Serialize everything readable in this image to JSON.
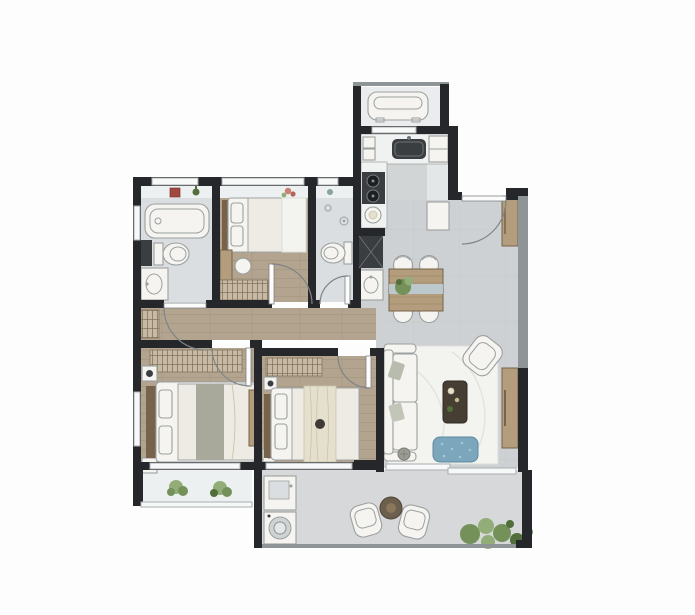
{
  "meta": {
    "type": "apartment-floor-plan",
    "description": "Top-down rendered floor plan of a 3-bedroom, 2-bath apartment with kitchen, equipment platform, dining/living area and long south balcony. No text labels are rendered in the plan."
  },
  "colors": {
    "wall": "#26272a",
    "wallSoft": "#8f9497",
    "windowFill": "#f7f8f8",
    "windowFrame": "#a9aeb1",
    "floorWood": "#b3a490",
    "floorWoodLine": "#9b8c76",
    "floorTile": "#cdd1d3",
    "tileLine": "#c3c7c9",
    "floorBath": "#dbdee0",
    "floorKitchen": "#e4e7e8",
    "counter": "#f0f1f1",
    "floorPlatform": "#ebeced",
    "floorBalcony": "#d6d8d9",
    "sill": "#edf0f1",
    "furnWhite": "#f5f4f0",
    "furnStroke": "#9ba09f",
    "furnWood": "#b49d7c",
    "furnWoodDark": "#77634b",
    "tableDark": "#473e33",
    "linen": "#edebe3",
    "blanket": "#e5dfcd",
    "throw": "#a8a89b",
    "hatchBg": "#c7b9a3",
    "hatchLine": "#82755f",
    "blue": "#7ba6bc",
    "blueDot": "#a6c4d4",
    "marble": "#f3f3ef",
    "marbleVein": "#dededa",
    "plant": "#739159",
    "plantLight": "#93ad78",
    "plantDark": "#516e3c",
    "appliance": "#3a3e41",
    "doorArc": "#7e8386",
    "leaf": "#fcfcfa",
    "accentRed": "#a04840",
    "glassBand": "#bcd0da"
  },
  "rooms": [
    {
      "id": "equipment-platform",
      "furniture": [
        "ac-outdoor-unit"
      ]
    },
    {
      "id": "kitchen",
      "furniture": [
        "counter",
        "sink",
        "two-burner-stove",
        "fridge",
        "island-cabinet"
      ]
    },
    {
      "id": "entry",
      "furniture": [
        "entry-door",
        "shoe-cabinet"
      ]
    },
    {
      "id": "bathroom-1",
      "furniture": [
        "bathtub",
        "toilet",
        "vanity-sink",
        "side-cabinet"
      ]
    },
    {
      "id": "small-bedroom",
      "furniture": [
        "single-bed",
        "desk",
        "chair",
        "wardrobe"
      ]
    },
    {
      "id": "bathroom-2",
      "furniture": [
        "shower-head",
        "toilet",
        "flue-duct",
        "wash-basin"
      ]
    },
    {
      "id": "dining-area",
      "furniture": [
        "dining-table",
        "four-chairs",
        "centerpiece-plant"
      ]
    },
    {
      "id": "living-room",
      "furniture": [
        "sofa",
        "throw-pillows",
        "coffee-table",
        "armchair",
        "blue-pouf",
        "marble-rug",
        "tv-cabinet",
        "floor-lamp"
      ]
    },
    {
      "id": "hallway",
      "furniture": [
        "linen-cabinet"
      ]
    },
    {
      "id": "master-bedroom",
      "furniture": [
        "double-bed",
        "nightstand-lamps",
        "wardrobe",
        "wall-panel"
      ]
    },
    {
      "id": "bedroom-3",
      "furniture": [
        "double-bed",
        "nightstands",
        "wardrobe",
        "draped-blanket"
      ]
    },
    {
      "id": "bay-window",
      "furniture": [
        "plants"
      ]
    },
    {
      "id": "balcony",
      "furniture": [
        "laundry-sink",
        "washing-machine",
        "two-lounge-chairs",
        "round-side-table",
        "plants"
      ]
    }
  ]
}
